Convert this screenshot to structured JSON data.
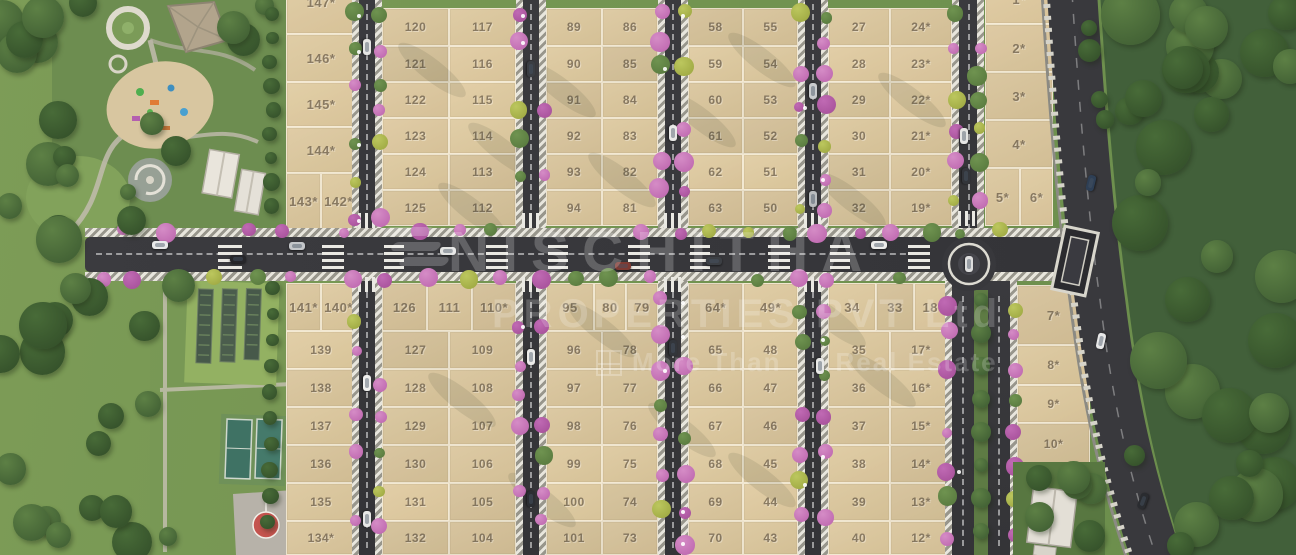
{
  "watermark": {
    "brand": "NISCHITHA",
    "subtitle": "PROPERTIES PVT Ltd",
    "tagline_left": "More Than",
    "tagline_right": "Real Estate"
  },
  "palette": {
    "plot_fill": "#d7c49d",
    "road": "#38383b",
    "grass": "#7f9e5b",
    "forest": "#42603a",
    "flower_pink": "#bb63ac",
    "flower_olive": "#9aa43e",
    "court_green": "#3f7264",
    "marking_red": "#c4544e",
    "paving_light": "#e8e6dd"
  },
  "plots": [
    [
      "147*",
      286,
      -30,
      70,
      64
    ],
    [
      "146*",
      286,
      34,
      70,
      48
    ],
    [
      "145*",
      286,
      82,
      70,
      45
    ],
    [
      "144*",
      286,
      127,
      70,
      46
    ],
    [
      "143*",
      286,
      173,
      35,
      57
    ],
    [
      "142*",
      321,
      173,
      35,
      57
    ],
    [
      "120",
      382,
      8,
      67,
      38
    ],
    [
      "121",
      382,
      46,
      67,
      36
    ],
    [
      "122",
      382,
      82,
      67,
      36
    ],
    [
      "123",
      382,
      118,
      67,
      36
    ],
    [
      "124",
      382,
      154,
      67,
      36
    ],
    [
      "125",
      382,
      190,
      67,
      36
    ],
    [
      "117",
      449,
      8,
      67,
      38
    ],
    [
      "116",
      449,
      46,
      67,
      36
    ],
    [
      "115",
      449,
      82,
      67,
      36
    ],
    [
      "114",
      449,
      118,
      67,
      36
    ],
    [
      "113",
      449,
      154,
      67,
      36
    ],
    [
      "112",
      449,
      190,
      67,
      36
    ],
    [
      "89",
      546,
      8,
      56,
      38
    ],
    [
      "90",
      546,
      46,
      56,
      36
    ],
    [
      "91",
      546,
      82,
      56,
      36
    ],
    [
      "92",
      546,
      118,
      56,
      36
    ],
    [
      "93",
      546,
      154,
      56,
      36
    ],
    [
      "94",
      546,
      190,
      56,
      36
    ],
    [
      "86",
      602,
      8,
      56,
      38
    ],
    [
      "85",
      602,
      46,
      56,
      36
    ],
    [
      "84",
      602,
      82,
      56,
      36
    ],
    [
      "83",
      602,
      118,
      56,
      36
    ],
    [
      "82",
      602,
      154,
      56,
      36
    ],
    [
      "81",
      602,
      190,
      56,
      36
    ],
    [
      "58",
      688,
      8,
      55,
      38
    ],
    [
      "59",
      688,
      46,
      55,
      36
    ],
    [
      "60",
      688,
      82,
      55,
      36
    ],
    [
      "61",
      688,
      118,
      55,
      36
    ],
    [
      "62",
      688,
      154,
      55,
      36
    ],
    [
      "63",
      688,
      190,
      55,
      36
    ],
    [
      "55",
      743,
      8,
      55,
      38
    ],
    [
      "54",
      743,
      46,
      55,
      36
    ],
    [
      "53",
      743,
      82,
      55,
      36
    ],
    [
      "52",
      743,
      118,
      55,
      36
    ],
    [
      "51",
      743,
      154,
      55,
      36
    ],
    [
      "50",
      743,
      190,
      55,
      36
    ],
    [
      "27",
      828,
      8,
      62,
      38
    ],
    [
      "28",
      828,
      46,
      62,
      36
    ],
    [
      "29",
      828,
      82,
      62,
      36
    ],
    [
      "30",
      828,
      118,
      62,
      36
    ],
    [
      "31",
      828,
      154,
      62,
      36
    ],
    [
      "32",
      828,
      190,
      62,
      36
    ],
    [
      "24*",
      890,
      8,
      62,
      38
    ],
    [
      "23*",
      890,
      46,
      62,
      36
    ],
    [
      "22*",
      890,
      82,
      62,
      36
    ],
    [
      "21*",
      890,
      118,
      62,
      36
    ],
    [
      "20*",
      890,
      154,
      62,
      36
    ],
    [
      "19*",
      890,
      190,
      62,
      36
    ],
    [
      "1*",
      985,
      -26,
      68,
      50
    ],
    [
      "2*",
      985,
      24,
      68,
      48
    ],
    [
      "3*",
      985,
      72,
      68,
      48
    ],
    [
      "4*",
      985,
      120,
      68,
      48
    ],
    [
      "5*",
      985,
      168,
      35,
      58
    ],
    [
      "6*",
      1020,
      168,
      33,
      58
    ],
    [
      "141*",
      286,
      283,
      35,
      48
    ],
    [
      "140*",
      321,
      283,
      35,
      48
    ],
    [
      "139",
      286,
      331,
      70,
      38
    ],
    [
      "138",
      286,
      369,
      70,
      38
    ],
    [
      "137",
      286,
      407,
      70,
      38
    ],
    [
      "136",
      286,
      445,
      70,
      38
    ],
    [
      "135",
      286,
      483,
      70,
      38
    ],
    [
      "134*",
      286,
      521,
      70,
      34
    ],
    [
      "126",
      382,
      283,
      45,
      48
    ],
    [
      "111",
      427,
      283,
      45,
      48
    ],
    [
      "110*",
      472,
      283,
      44,
      48
    ],
    [
      "127",
      382,
      331,
      67,
      38
    ],
    [
      "128",
      382,
      369,
      67,
      38
    ],
    [
      "129",
      382,
      407,
      67,
      38
    ],
    [
      "130",
      382,
      445,
      67,
      38
    ],
    [
      "131",
      382,
      483,
      67,
      38
    ],
    [
      "132",
      382,
      521,
      67,
      34
    ],
    [
      "109",
      449,
      331,
      67,
      38
    ],
    [
      "108",
      449,
      369,
      67,
      38
    ],
    [
      "107",
      449,
      407,
      67,
      38
    ],
    [
      "106",
      449,
      445,
      67,
      38
    ],
    [
      "105",
      449,
      483,
      67,
      38
    ],
    [
      "104",
      449,
      521,
      67,
      34
    ],
    [
      "95",
      546,
      283,
      48,
      48
    ],
    [
      "80",
      594,
      283,
      32,
      48
    ],
    [
      "79",
      626,
      283,
      32,
      48
    ],
    [
      "96",
      546,
      331,
      56,
      38
    ],
    [
      "97",
      546,
      369,
      56,
      38
    ],
    [
      "98",
      546,
      407,
      56,
      38
    ],
    [
      "99",
      546,
      445,
      56,
      38
    ],
    [
      "100",
      546,
      483,
      56,
      38
    ],
    [
      "101",
      546,
      521,
      56,
      34
    ],
    [
      "78",
      602,
      331,
      56,
      38
    ],
    [
      "77",
      602,
      369,
      56,
      38
    ],
    [
      "76",
      602,
      407,
      56,
      38
    ],
    [
      "75",
      602,
      445,
      56,
      38
    ],
    [
      "74",
      602,
      483,
      56,
      38
    ],
    [
      "73",
      602,
      521,
      56,
      34
    ],
    [
      "64*",
      688,
      283,
      55,
      48
    ],
    [
      "49*",
      743,
      283,
      55,
      48
    ],
    [
      "65",
      688,
      331,
      55,
      38
    ],
    [
      "66",
      688,
      369,
      55,
      38
    ],
    [
      "67",
      688,
      407,
      55,
      38
    ],
    [
      "68",
      688,
      445,
      55,
      38
    ],
    [
      "69",
      688,
      483,
      55,
      38
    ],
    [
      "70",
      688,
      521,
      55,
      34
    ],
    [
      "48",
      743,
      331,
      55,
      38
    ],
    [
      "47",
      743,
      369,
      55,
      38
    ],
    [
      "46",
      743,
      407,
      55,
      38
    ],
    [
      "45",
      743,
      445,
      55,
      38
    ],
    [
      "44",
      743,
      483,
      55,
      38
    ],
    [
      "43",
      743,
      521,
      55,
      34
    ],
    [
      "34",
      828,
      283,
      48,
      48
    ],
    [
      "33",
      876,
      283,
      38,
      48
    ],
    [
      "18*",
      914,
      283,
      38,
      48
    ],
    [
      "35",
      828,
      331,
      62,
      38
    ],
    [
      "36",
      828,
      369,
      62,
      38
    ],
    [
      "37",
      828,
      407,
      62,
      38
    ],
    [
      "38",
      828,
      445,
      62,
      38
    ],
    [
      "39",
      828,
      483,
      62,
      38
    ],
    [
      "40",
      828,
      521,
      62,
      34
    ],
    [
      "17*",
      890,
      331,
      62,
      38
    ],
    [
      "16*",
      890,
      369,
      62,
      38
    ],
    [
      "15*",
      890,
      407,
      62,
      38
    ],
    [
      "14*",
      890,
      445,
      62,
      38
    ],
    [
      "13*",
      890,
      483,
      62,
      38
    ],
    [
      "12*",
      890,
      521,
      62,
      34
    ],
    [
      "7*",
      1017,
      285,
      73,
      60
    ],
    [
      "8*",
      1017,
      345,
      73,
      40
    ],
    [
      "9*",
      1017,
      385,
      73,
      38
    ],
    [
      "10*",
      1017,
      423,
      73,
      42
    ]
  ]
}
